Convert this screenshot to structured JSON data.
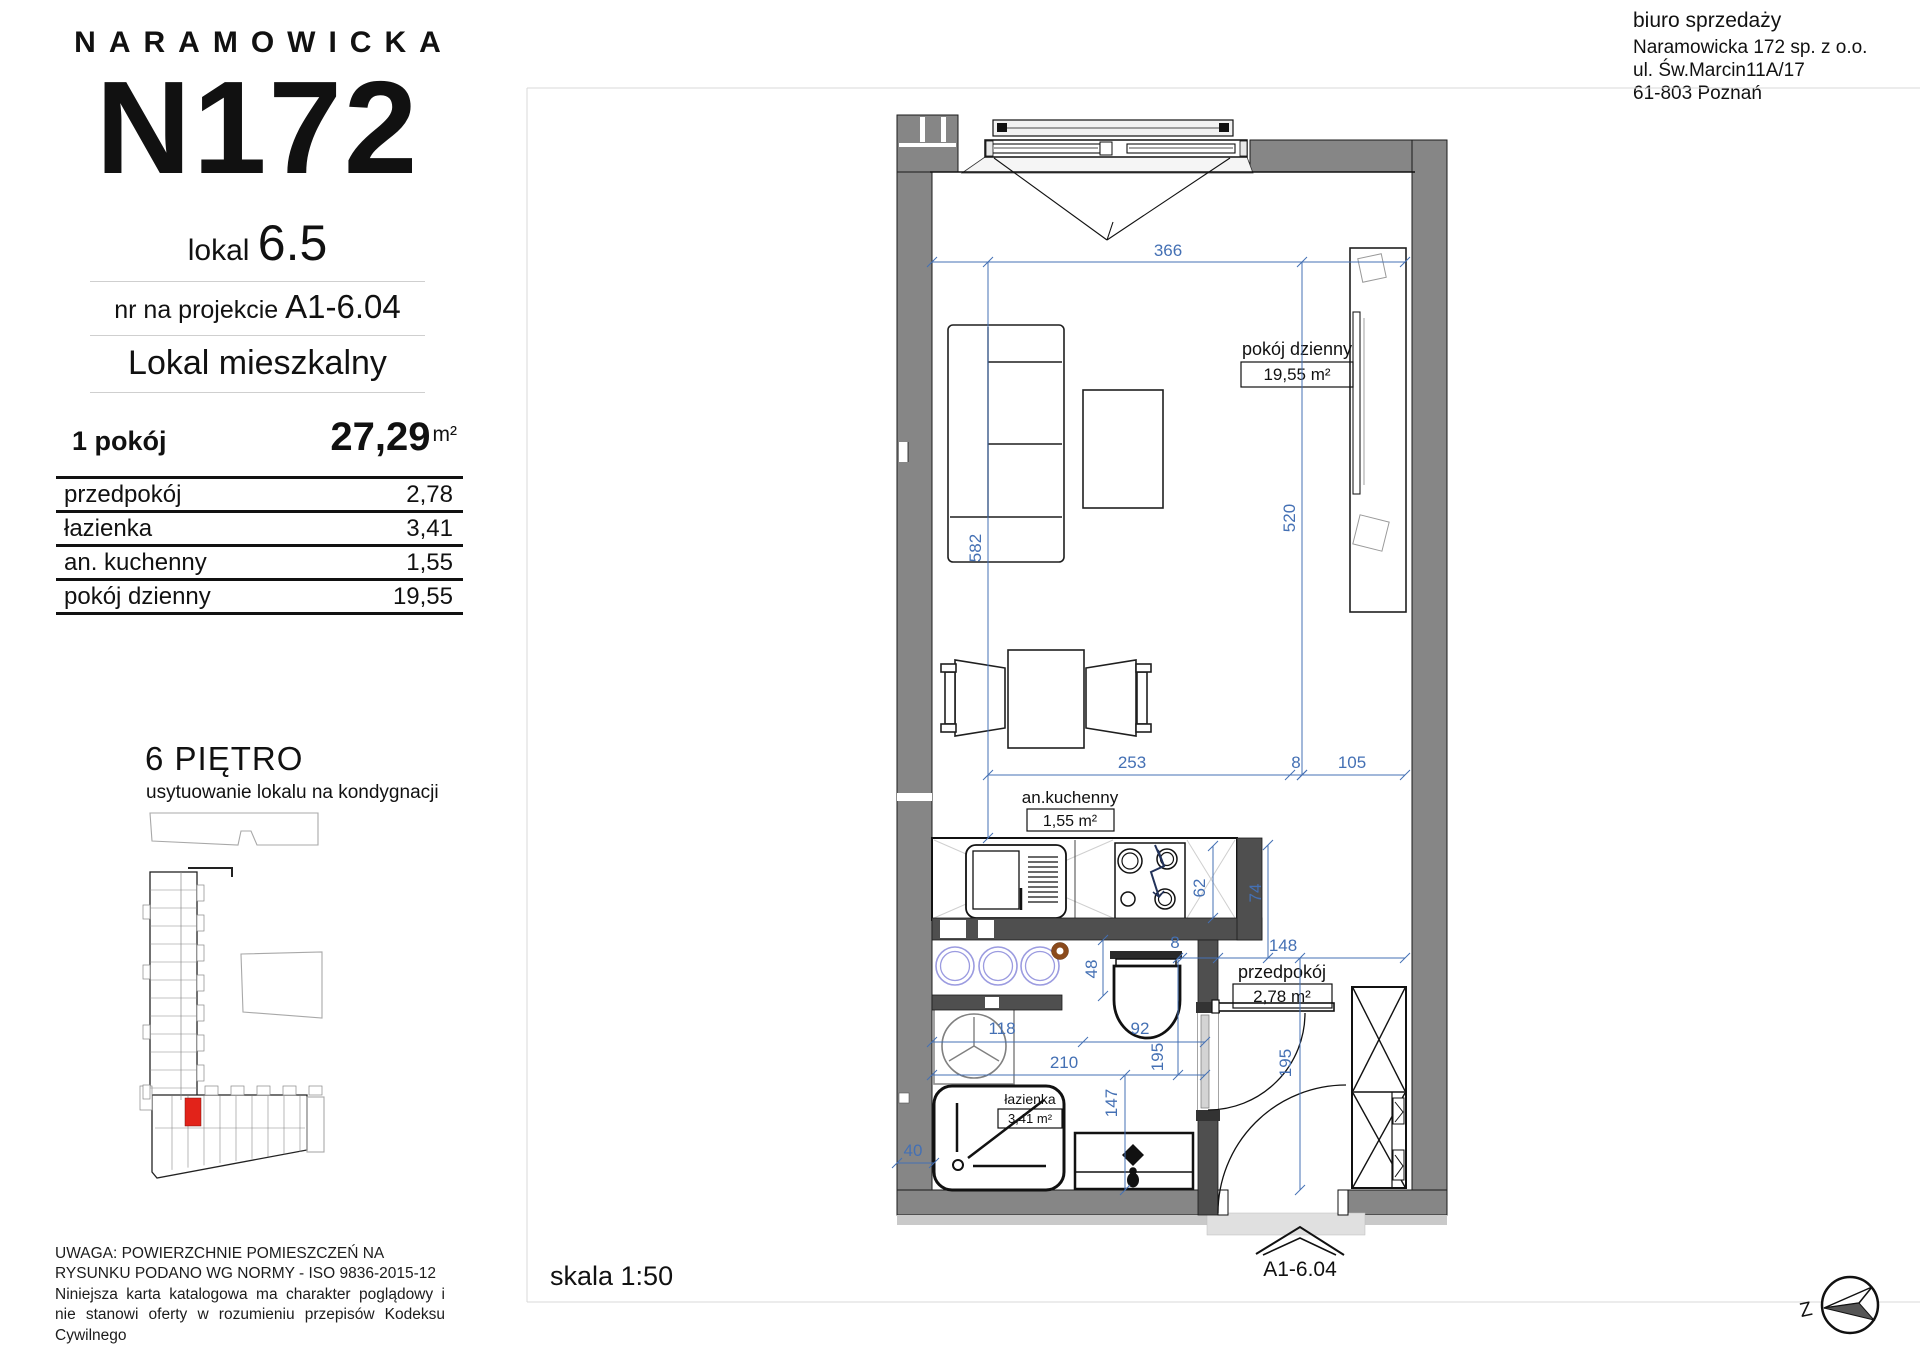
{
  "logo": {
    "brand": "NARAMOWICKA",
    "building": "N172"
  },
  "unit": {
    "lokal_label": "lokal",
    "lokal_number": "6.5",
    "project_label": "nr na projekcie",
    "project_number": "A1-6.04",
    "type": "Lokal mieszkalny"
  },
  "summary": {
    "rooms": "1 pokój",
    "area": "27,29",
    "area_unit": "m²"
  },
  "rooms_table": [
    {
      "name": "przedpokój",
      "area": "2,78"
    },
    {
      "name": "łazienka",
      "area": "3,41"
    },
    {
      "name": "an. kuchenny",
      "area": "1,55"
    },
    {
      "name": "pokój dzienny",
      "area": "19,55"
    }
  ],
  "floor": {
    "title": "6 PIĘTRO",
    "subtitle": "usytuowanie lokalu na kondygnacji"
  },
  "disclaimer": {
    "line1": "UWAGA: POWIERZCHNIE POMIESZCZEŃ NA RYSUNKU PODANO WG NORMY - ISO 9836-2015-12",
    "line2": "Niniejsza karta katalogowa ma charakter poglądowy i nie stanowi oferty w rozumieniu przepisów Kodeksu Cywilnego"
  },
  "sales_office": {
    "title": "biuro sprzedaży",
    "company": "Naramowicka 172 sp. z o.o.",
    "street": "ul. Św.Marcin11A/17",
    "city": "61-803 Poznań"
  },
  "plan": {
    "scale": "skala 1:50",
    "entrance_label": "A1-6.04",
    "compass_letter": "Z",
    "room_labels": [
      {
        "name": "pokój dzienny",
        "area": "19,55 m²",
        "tx": 1297,
        "ty": 355,
        "bx": 1241,
        "by": 362,
        "bw": 112,
        "bh": 25,
        "vx": 1297,
        "vy": 380,
        "fs": 18
      },
      {
        "name": "an.kuchenny",
        "area": "1,55 m²",
        "tx": 1070,
        "ty": 803,
        "bx": 1027,
        "by": 809,
        "bw": 87,
        "bh": 22,
        "vx": 1070,
        "vy": 826,
        "fs": 17
      },
      {
        "name": "przedpokój",
        "area": "2,78 m²",
        "tx": 1282,
        "ty": 978,
        "bx": 1233,
        "by": 984,
        "bw": 99,
        "bh": 24,
        "vx": 1282,
        "vy": 1002,
        "fs": 18
      },
      {
        "name": "łazienka",
        "area": "3,41 m²",
        "tx": 1030,
        "ty": 1104,
        "bx": 998,
        "by": 1109,
        "bw": 64,
        "bh": 19,
        "vx": 1030,
        "vy": 1123,
        "fs": 14
      }
    ],
    "dimensions": [
      {
        "t": "366",
        "x": 1168,
        "y": 256,
        "r": 0
      },
      {
        "t": "582",
        "x": 981,
        "y": 548,
        "r": -90
      },
      {
        "t": "520",
        "x": 1295,
        "y": 518,
        "r": -90
      },
      {
        "t": "253",
        "x": 1132,
        "y": 768,
        "r": 0
      },
      {
        "t": "8",
        "x": 1296,
        "y": 768,
        "r": 0
      },
      {
        "t": "105",
        "x": 1352,
        "y": 768,
        "r": 0
      },
      {
        "t": "62",
        "x": 1205,
        "y": 888,
        "r": -90
      },
      {
        "t": "74",
        "x": 1261,
        "y": 893,
        "r": -90
      },
      {
        "t": "48",
        "x": 1097,
        "y": 969,
        "r": -90
      },
      {
        "t": "8",
        "x": 1175,
        "y": 948,
        "r": 0
      },
      {
        "t": "148",
        "x": 1283,
        "y": 951,
        "r": 0
      },
      {
        "t": "118",
        "x": 1002,
        "y": 1034,
        "r": 0
      },
      {
        "t": "92",
        "x": 1140,
        "y": 1034,
        "r": 0
      },
      {
        "t": "210",
        "x": 1064,
        "y": 1068,
        "r": 0
      },
      {
        "t": "195",
        "x": 1163,
        "y": 1057,
        "r": -90
      },
      {
        "t": "147",
        "x": 1117,
        "y": 1103,
        "r": -90
      },
      {
        "t": "195",
        "x": 1291,
        "y": 1063,
        "r": -90
      },
      {
        "t": "40",
        "x": 913,
        "y": 1156,
        "r": 0
      }
    ]
  },
  "colors": {
    "dimension_blue": "#4470b4",
    "wall_gray": "#868686",
    "partition_gray": "#4f4f4f",
    "unit_highlight_red": "#e2231a",
    "laundry_circle_blue": "#9b9be0",
    "knob_brown": "#8a4a1c"
  }
}
